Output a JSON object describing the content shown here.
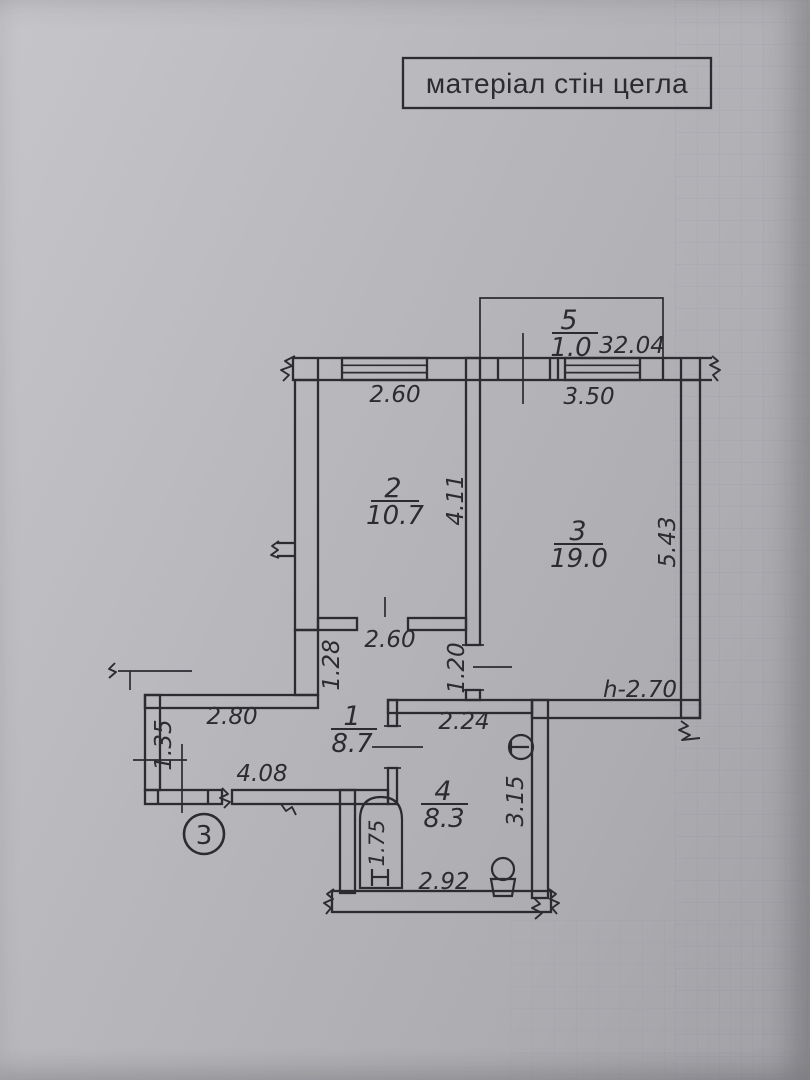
{
  "title": "матеріал стін цегла",
  "floor_marker": "3",
  "rooms": [
    {
      "number": "1",
      "area": "8.7"
    },
    {
      "number": "2",
      "area": "10.7"
    },
    {
      "number": "3",
      "area": "19.0"
    },
    {
      "number": "4",
      "area": "8.3"
    },
    {
      "number": "5",
      "area": "1.0"
    }
  ],
  "total_area": "32.04",
  "ceiling_height": "h-2.70",
  "dimensions": {
    "room2_width": "2.60",
    "room2_depth": "4.11",
    "room3_width": "3.50",
    "room3_depth": "5.43",
    "room1_opening": "2.60",
    "room1_left_depth": "1.28",
    "room3_door": "1.20",
    "room4_width_top": "2.24",
    "room1_width_top": "2.80",
    "room1_width_bottom": "4.08",
    "room1_left_height": "1.35",
    "room4_width_bottom": "2.92",
    "room4_depth": "3.15",
    "bathtub_length": "1.75"
  },
  "colors": {
    "ink": "#2b2b30",
    "paper": "#b3b3b6"
  }
}
